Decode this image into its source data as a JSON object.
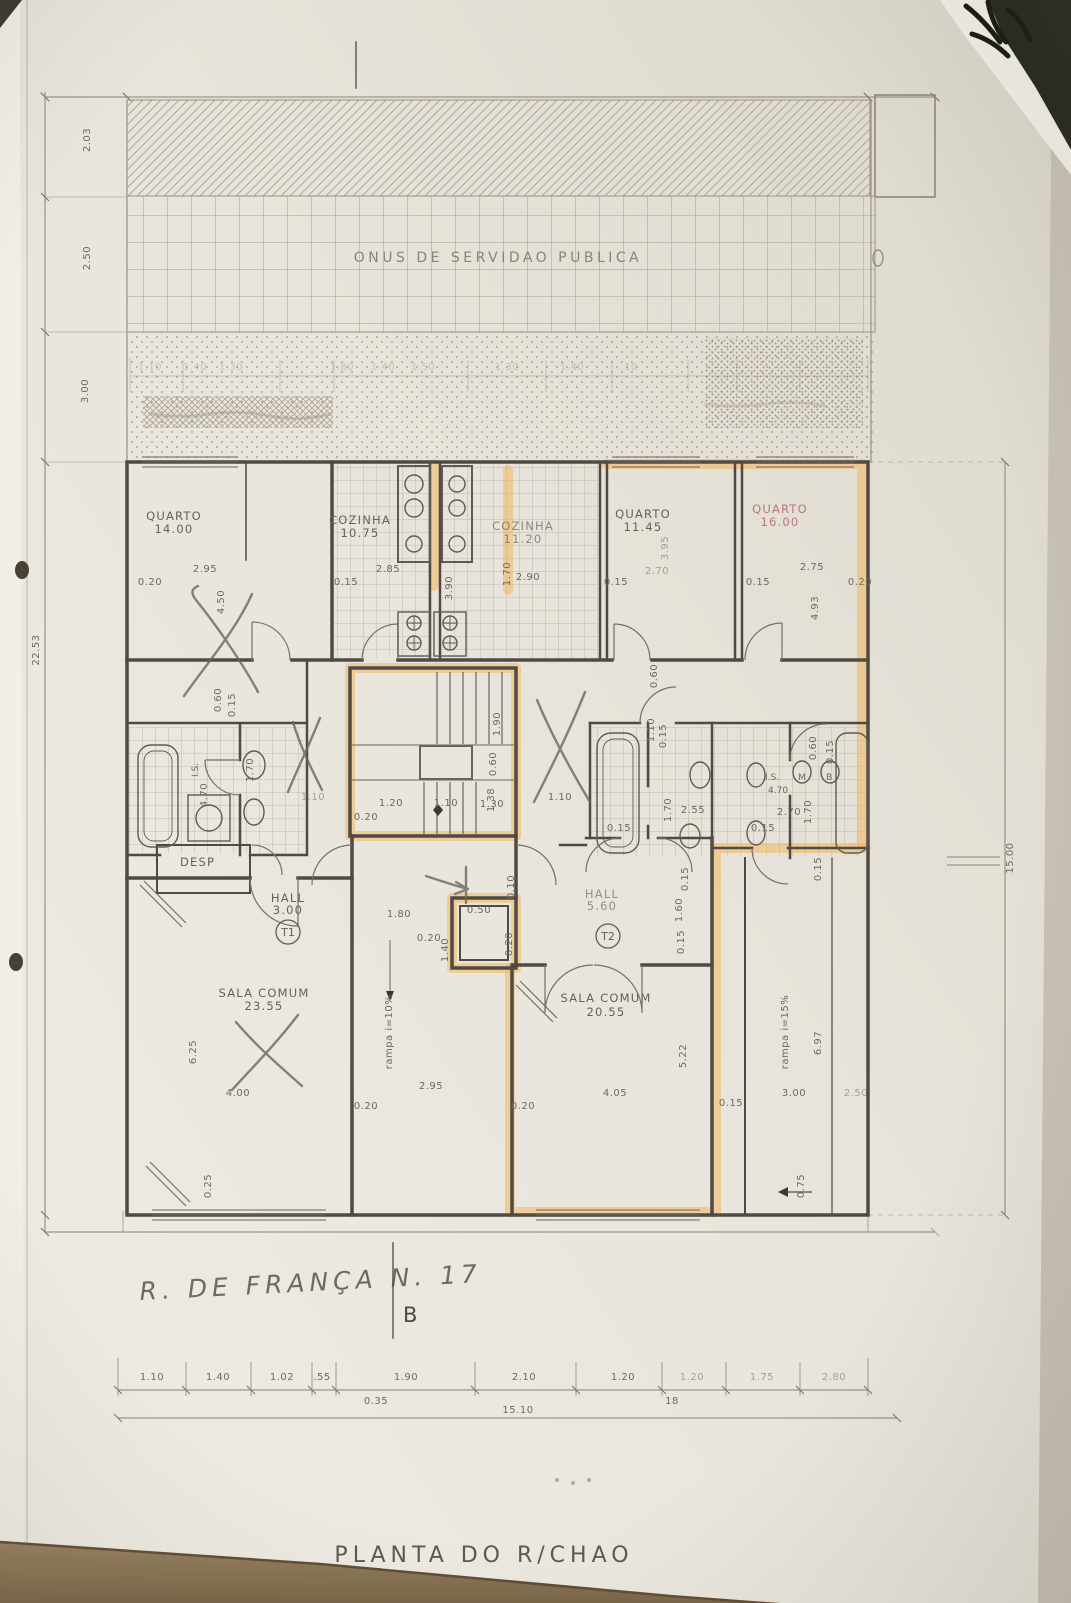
{
  "title": {
    "text": "PLANTA DO R/CHAO"
  },
  "servitude_label": "ONUS DE SERVIDAO PUBLICA",
  "handwriting": {
    "street": "R. DE FRANÇA N. 17",
    "section": "B"
  },
  "unit_tags": {
    "t1": "T1",
    "t2": "T2"
  },
  "rooms": {
    "quarto1": {
      "name": "QUARTO",
      "area": "14.00"
    },
    "cozinha1": {
      "name": "COZINHA",
      "area": "10.75"
    },
    "cozinha2": {
      "name": "COZINHA",
      "area": "11.20"
    },
    "quarto2": {
      "name": "QUARTO",
      "area": "11.45"
    },
    "quarto3": {
      "name": "QUARTO",
      "area": "16.00"
    },
    "sala1": {
      "name": "SALA COMUM",
      "area": "23.55"
    },
    "sala2": {
      "name": "SALA COMUM",
      "area": "20.55"
    },
    "hall1": {
      "name": "HALL",
      "area": "3.00"
    },
    "hall2": {
      "name": "HALL",
      "area": "5.60"
    },
    "desp": {
      "name": "DESP"
    },
    "is1": {
      "name": "I.S.",
      "area": "4.70"
    },
    "is2": {
      "name": "I.S.",
      "area": "4.70"
    },
    "fixture_m": "M",
    "fixture_b": "B"
  },
  "ramps": {
    "left": "rampa i=10%",
    "right": "rampa i=15%"
  },
  "outer_dims": {
    "left_chain": [
      "2.03",
      "2.50",
      "3.00"
    ],
    "left_total": "22.53",
    "right_total": "15.00",
    "top_chain": [
      "1.10",
      "1.40",
      "1.30",
      "1.80",
      "1.40",
      "1.50",
      "1.30",
      "1.40",
      ".10"
    ],
    "bottom_chain": [
      "1.10",
      "1.40",
      "1.02",
      ".55",
      "1.90",
      "2.10",
      "1.20",
      "1.20",
      "1.75",
      "2.80"
    ],
    "bottom_sub": "0.35",
    "bottom_note": "18",
    "bottom_total": "15.10"
  },
  "interior_dims": [
    "0.20",
    "2.95",
    "4.50",
    "0.15",
    "2.85",
    "3.90",
    "1.70",
    "2.90",
    "0.15",
    "2.70",
    "0.15",
    "2.75",
    "4.93",
    "0.20",
    "3.95",
    "0.60",
    "0.15",
    "4.70",
    "1.70",
    "1.10",
    "1.90",
    "0.60",
    "1.38",
    "1.20",
    "1.10",
    "1.30",
    "0.20",
    "1.10",
    "0.15",
    "0.60",
    "1.70",
    "2.55",
    "0.15",
    "2.70",
    "1.70",
    "0.60",
    "0.15",
    "0.15",
    "0.15",
    "1.60",
    "0.15",
    "1.80",
    "0.20",
    "1.40",
    "0.50",
    "0.20",
    "0.10",
    "1.10",
    "6.25",
    "4.00",
    "0.20",
    "2.95",
    "5.22",
    "4.05",
    "0.20",
    "0.15",
    "6.97",
    "3.00",
    "0.15",
    "0.75",
    "0.25",
    "2.50"
  ],
  "colors": {
    "highlighter": "#f3b75f",
    "paper": "#e9e5dc",
    "table": "#8c7757",
    "red_label": "#b5626d"
  }
}
